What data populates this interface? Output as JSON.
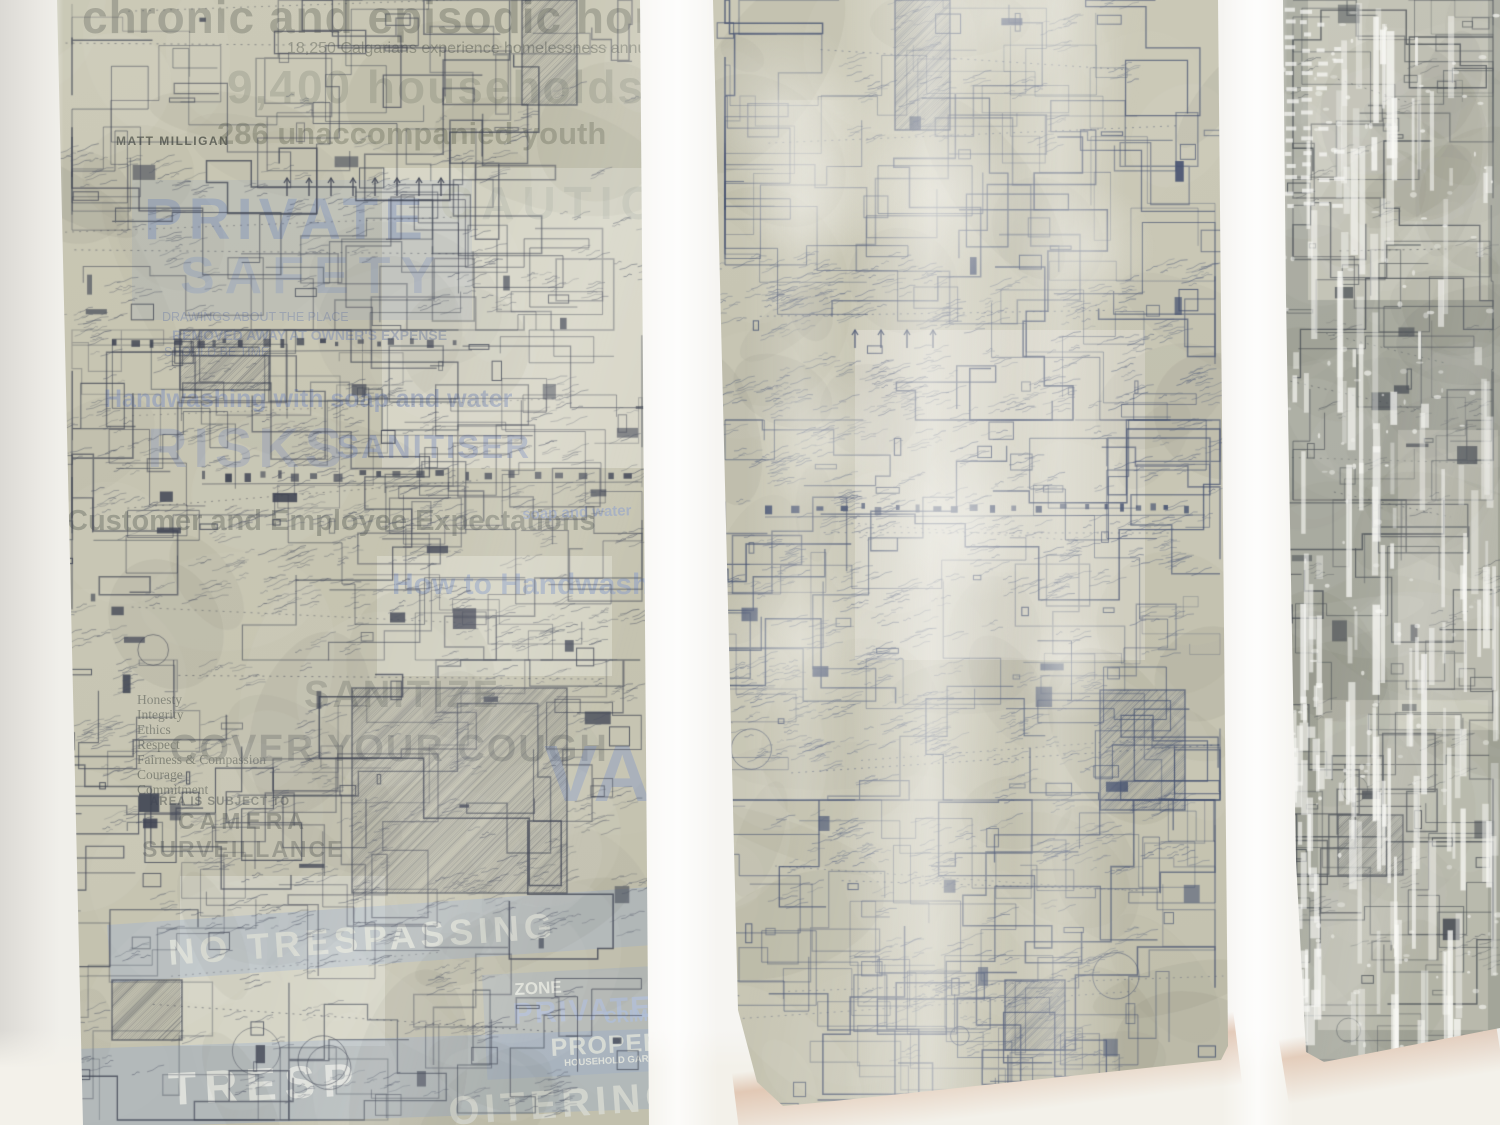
{
  "scene": {
    "description": "Photograph of three tall mixed-media panels hung on a white gallery wall. Each panel is an architectural site-plan drawing in dark blue ink covered with dense handwritten annotations; faint screen-printed ghost text overlays the left panel; the middle panel has translucent white paint washes; the right panel is grayer with vertical white paint drips.",
    "setting": "gallery wall",
    "panel_count": 3
  },
  "colors": {
    "wall": "#efeeea",
    "wall_gap_highlight": "#fbfaf7",
    "wall_bottom": "#f3f1ea",
    "panel_left_bg": "#c7c5b2",
    "panel_mid_bg": "#c9c7b5",
    "panel_right_bg": "#a9aba0",
    "ink_dark": "#3e4352",
    "ink_blue": "#44506f",
    "ink_gray": "#4a4f55",
    "scribble_dark": "#4a5062",
    "scribble_blue": "#4c5878",
    "ghost_gray": "#8f9083",
    "ghost_blue": "#8496bf",
    "band_blue": "#a3b4d1",
    "wash_white": "#f4f3ee",
    "drip_white": "#fafaf6",
    "shadow_warm": "#d0a080"
  },
  "panels": [
    {
      "id": "left",
      "media": "ink site plan with handwritten annotations and ghost screen-print text",
      "ghost_texts": [
        {
          "text": "chronic and episodic homelessness."
        },
        {
          "text": "18,250 Calgarians experience homelessness annually."
        },
        {
          "text": "9,400 households"
        },
        {
          "text": "286 unaccompanied youth"
        },
        {
          "text": "MATT MILLIGAN"
        },
        {
          "text": "CAUTION"
        },
        {
          "text": "PRIVATE"
        },
        {
          "text": "SAFETY"
        },
        {
          "text": "DRAWINGS ABOUT THE PLACE"
        },
        {
          "text": "REMOVED AWAY AT OWNER'S EXPENSE"
        },
        {
          "text": "SHOULD BE TIME"
        },
        {
          "text": "Handwashing with soap and water"
        },
        {
          "text": "RISKS"
        },
        {
          "text": "SANITISER"
        },
        {
          "text": "Customer and Employee Expectations"
        },
        {
          "text": "How to Handwash"
        },
        {
          "text": "soap and water"
        },
        {
          "text": "SANITIZE"
        },
        {
          "text": "COVER YOUR COUGH"
        },
        {
          "text": "Honesty"
        },
        {
          "text": "Integrity"
        },
        {
          "text": "Ethics"
        },
        {
          "text": "Respect"
        },
        {
          "text": "Fairness & Compassion"
        },
        {
          "text": "Courage"
        },
        {
          "text": "Commitment"
        },
        {
          "text": "AREA IS SUBJECT TO"
        },
        {
          "text": "CAMERA"
        },
        {
          "text": "SURVEILLANCE"
        },
        {
          "text": "VATE"
        },
        {
          "text": "NO TRESPASSING"
        },
        {
          "text": "ZONE"
        },
        {
          "text": "PRIVATE"
        },
        {
          "text": "PROPERTY"
        },
        {
          "text": "CRIME"
        },
        {
          "text": "HOUSEHOLD GARBAGE"
        },
        {
          "text": "TRESP"
        },
        {
          "text": "OITERING"
        }
      ]
    },
    {
      "id": "middle",
      "media": "blue ink site plan with dense handwritten annotations and white paint washes",
      "ghost_texts": []
    },
    {
      "id": "right",
      "media": "gray site plan panel with vertical white paint drips and spatters",
      "ghost_texts": []
    }
  ]
}
